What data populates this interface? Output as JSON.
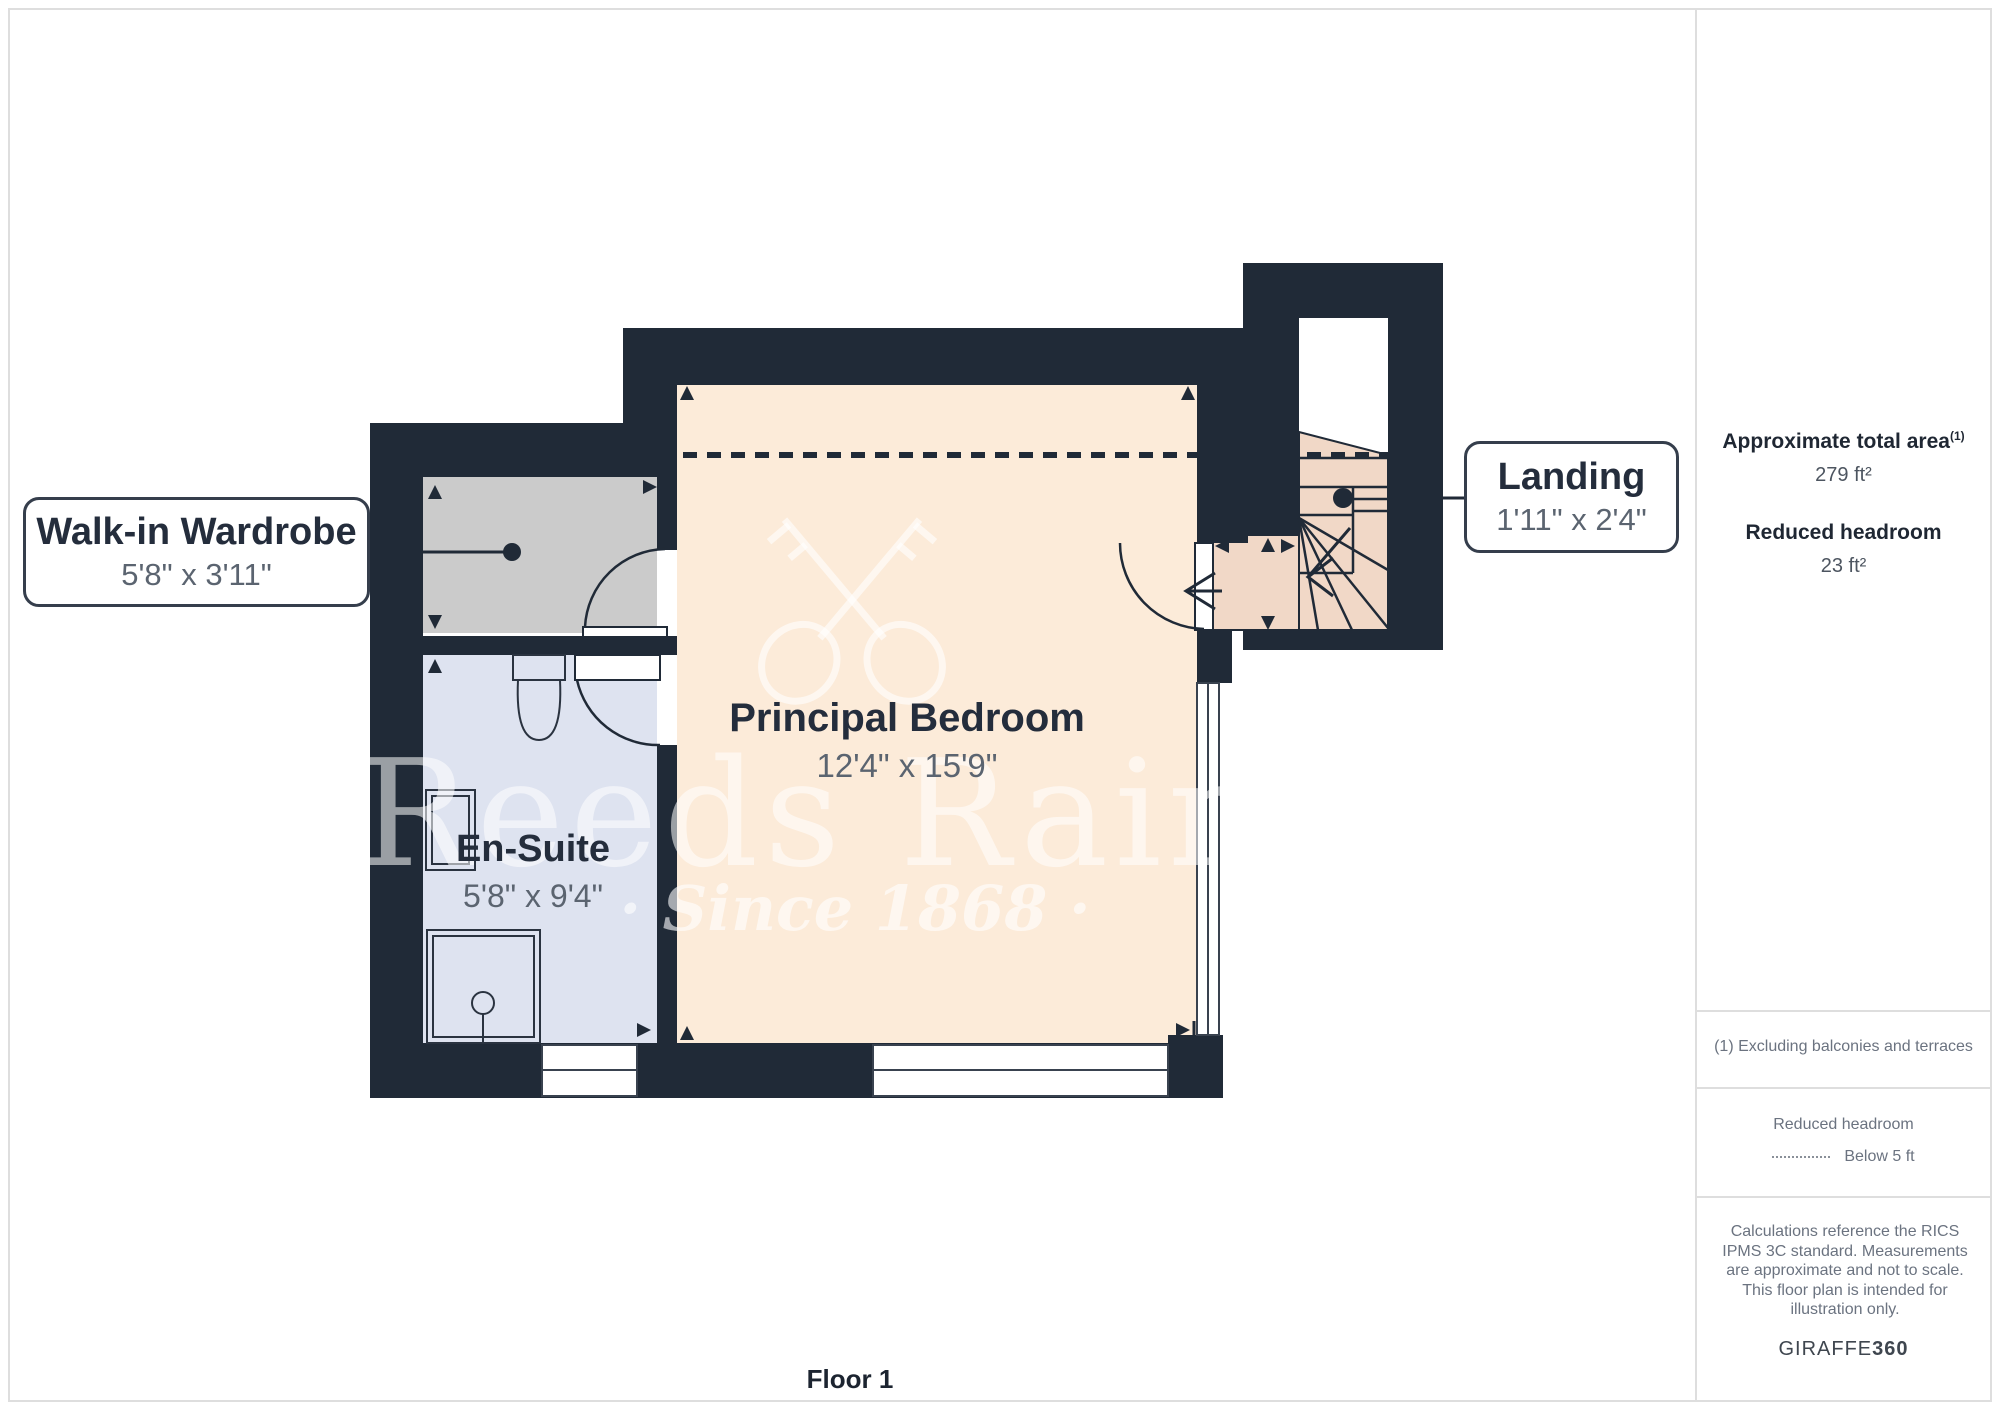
{
  "page": {
    "floor_label": "Floor 1"
  },
  "watermark": {
    "brand": "Reeds Rains",
    "tagline": "· Since 1868 ·"
  },
  "rooms": {
    "wardrobe": {
      "name": "Walk-in Wardrobe",
      "dims": "5'8\" x 3'11\""
    },
    "bedroom": {
      "name": "Principal Bedroom",
      "dims": "12'4\" x 15'9\""
    },
    "ensuite": {
      "name": "En-Suite",
      "dims": "5'8\" x 9'4\""
    },
    "landing": {
      "name": "Landing",
      "dims": "1'11\" x 2'4\""
    }
  },
  "sidebar": {
    "area_label": "Approximate total area",
    "area_footnote_marker": "(1)",
    "area_value": "279 ft²",
    "headroom_label": "Reduced headroom",
    "headroom_value": "23 ft²",
    "footnote": "(1) Excluding balconies and terraces",
    "legend_title": "Reduced headroom",
    "legend_item": "Below 5 ft",
    "disclaimer": "Calculations reference the RICS IPMS 3C standard. Measurements are approximate and not to scale. This floor plan is intended for illustration only.",
    "brand_normal": "GIRAFFE",
    "brand_bold": "360"
  },
  "colors": {
    "wall": "#202A37",
    "bedroom_fill": "#FCEBD9",
    "stairs_fill": "#F1D8C7",
    "wardrobe_fill": "#CBCBCB",
    "ensuite_fill": "#DEE3F0"
  }
}
